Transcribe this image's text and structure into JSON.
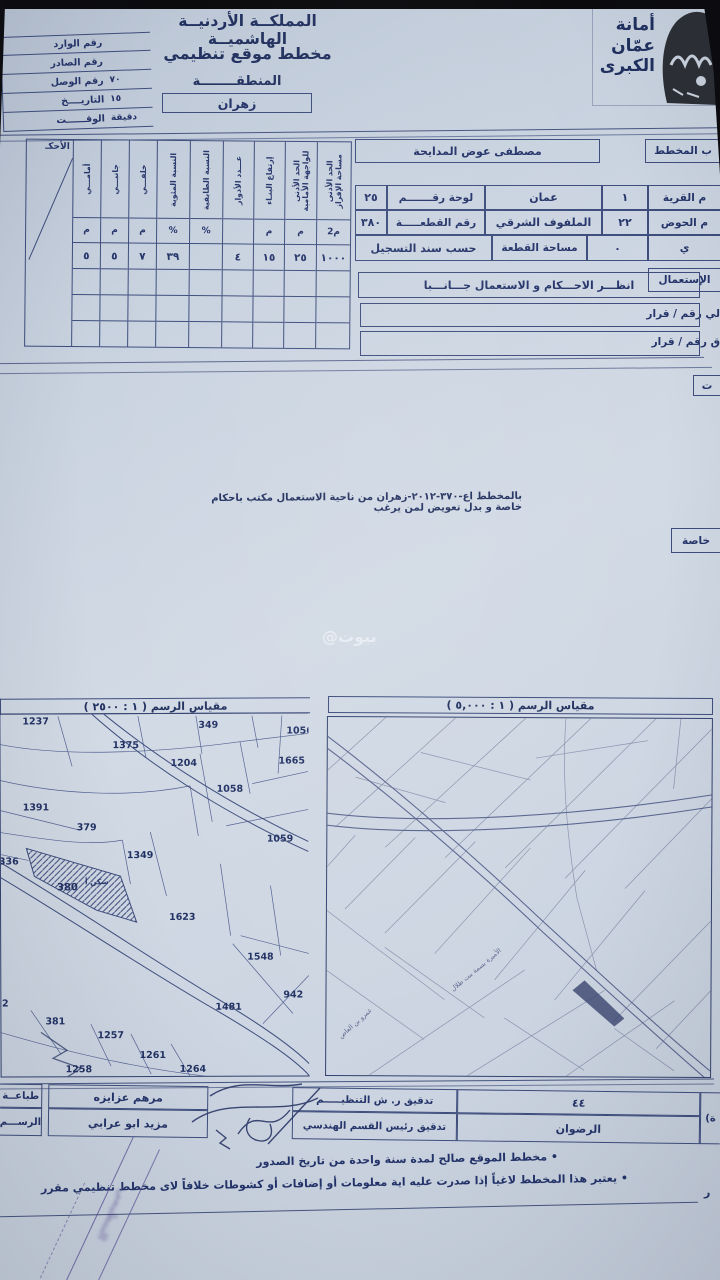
{
  "colors": {
    "paper": "#ccd5e1",
    "ink": "#25346a",
    "table_line": "#3e4d7d",
    "pencil": "#8089a6",
    "stamp": "#584c94"
  },
  "watermark": "بيوت@",
  "header": {
    "logo": {
      "line1": "أمانة",
      "line2": "عمّان",
      "line3": "الكبرى"
    },
    "kingdom_title": "المملكــة الأردنيــة الهاشميــة",
    "doc_title": "مخطط موقع تنظيمي",
    "region_label": "المنطقــــــــة",
    "region_value": "زهران",
    "ref_rows": [
      {
        "label": "رقم الوارد",
        "value": ""
      },
      {
        "label": "رقم الصادر",
        "value": ""
      },
      {
        "label": "رقم الوصل",
        "value": "٧٠"
      },
      {
        "label": "التاريــــخ",
        "value": "١٥"
      },
      {
        "label": "الوقــــــت",
        "value": "دقيقة"
      }
    ]
  },
  "details": {
    "applicant_label": "ب المخطط",
    "applicant_value": "مصطفى عوض المدايحة",
    "village_label": "م القرية",
    "village_no": "١",
    "village_name": "عمان",
    "sheet_label": "لوحة رقـــــــم",
    "sheet_no": "٢٥",
    "basin_label": "م الحوض",
    "basin_no": "٢٢",
    "basin_name": "الملفوف الشرقي",
    "parcel_label": "رقم القطعـــــة",
    "parcel_no": "٣٨٠",
    "row3_label": "ي",
    "row3_no": "٠",
    "area_label": "مساحة القطعة",
    "area_value": "حسب سند التسجيل",
    "usage_label": "الإستعمال",
    "usage_value": "انظـــر الاحـــكام و الاستعمال جـــانـــبا",
    "decision1_label": "لي رقم / قرار",
    "decision2_label": "ق رقم / قرار",
    "notes_tab": "ت",
    "special_tab": "خاصة"
  },
  "regulations": {
    "columns": [
      {
        "header": "الحد الأدنى\nمساحة الإفراز",
        "unit": "م2",
        "value": "١٠٠٠"
      },
      {
        "header": "الحد الأدنى\nللواجهة الأمامية",
        "unit": "م",
        "value": "٢٥"
      },
      {
        "header": "إرتفاع البنـاء",
        "unit": "م",
        "value": "١٥"
      },
      {
        "header": "عـــدد الأدوار",
        "unit": "",
        "value": "٤"
      },
      {
        "header": "النسبة الطابقية",
        "unit": "%",
        "value": ""
      },
      {
        "header": "النسبة المئوية",
        "unit": "%",
        "value": "٣٩"
      },
      {
        "header": "خلفـــي",
        "unit": "م",
        "value": "٧"
      },
      {
        "header": "جانبـــي",
        "unit": "م",
        "value": "٥"
      },
      {
        "header": "أمامـــي",
        "unit": "م",
        "value": "٥"
      },
      {
        "header": "",
        "unit": "",
        "value": "",
        "corner": "الأحكـ"
      }
    ]
  },
  "special_note": "بالمخطط اع-٣٧٠-٢٠١٢-زهران من ناحية الاستعمال مكتب باحكام خاصة و بدل تعويض لمن يرغب",
  "maps": {
    "left": {
      "scale_label": "مقياس الرسم ( ١ : ٢٥٠٠ )",
      "subject_parcel": {
        "number": "380",
        "zone_label": "سكن أ"
      },
      "parcels": [
        {
          "n": "1237",
          "x": 22,
          "y": 2
        },
        {
          "n": "349",
          "x": 198,
          "y": 6
        },
        {
          "n": "1056",
          "x": 286,
          "y": 12
        },
        {
          "n": "1375",
          "x": 112,
          "y": 26
        },
        {
          "n": "1204",
          "x": 170,
          "y": 44
        },
        {
          "n": "1665",
          "x": 278,
          "y": 42
        },
        {
          "n": "1058",
          "x": 216,
          "y": 70
        },
        {
          "n": "1391",
          "x": 22,
          "y": 88
        },
        {
          "n": "379",
          "x": 76,
          "y": 108
        },
        {
          "n": "1059",
          "x": 266,
          "y": 120
        },
        {
          "n": "1349",
          "x": 126,
          "y": 136
        },
        {
          "n": "336",
          "x": -2,
          "y": 142
        },
        {
          "n": "1623",
          "x": 168,
          "y": 198
        },
        {
          "n": "1548",
          "x": 246,
          "y": 238
        },
        {
          "n": "942",
          "x": 282,
          "y": 276
        },
        {
          "n": "1481",
          "x": 214,
          "y": 288
        },
        {
          "n": "32",
          "x": -6,
          "y": 284
        },
        {
          "n": "381",
          "x": 44,
          "y": 302
        },
        {
          "n": "1257",
          "x": 96,
          "y": 316
        },
        {
          "n": "1261",
          "x": 138,
          "y": 336
        },
        {
          "n": "1258",
          "x": 64,
          "y": 350
        },
        {
          "n": "1264",
          "x": 178,
          "y": 350
        }
      ]
    },
    "right": {
      "scale_label": "مقياس الرسم ( ١ : ٥,٠٠٠ )",
      "streets": [
        "الأميرة بسمة بنت طلال",
        "عمرو بن العاص"
      ]
    }
  },
  "approval": {
    "print_label": "طباعــة",
    "draw_label": "الرســـم",
    "printed_by": "مرهم عزايزه",
    "drawn_by": "مزيد ابو عرابي",
    "audit_org": "تدقيق ر. ش التنظيـــــم",
    "audit_eng": "تدقيق رئيس القسم الهندسي",
    "district_no": "٤٤",
    "district_name": "الرضوان",
    "cut_label": "(ة"
  },
  "footer": {
    "notes": [
      "مخطط الموقع صالح لمدة سنة واحدة من تاريخ الصدور",
      "يعتبر هذا المخطط لاغياً إذا صدرت عليه اية معلومات أو إضافات أو كشوطات خلافاً لاى مخطط تنظيمي مقرر"
    ],
    "bullet": "•",
    "side_char": "ر"
  }
}
